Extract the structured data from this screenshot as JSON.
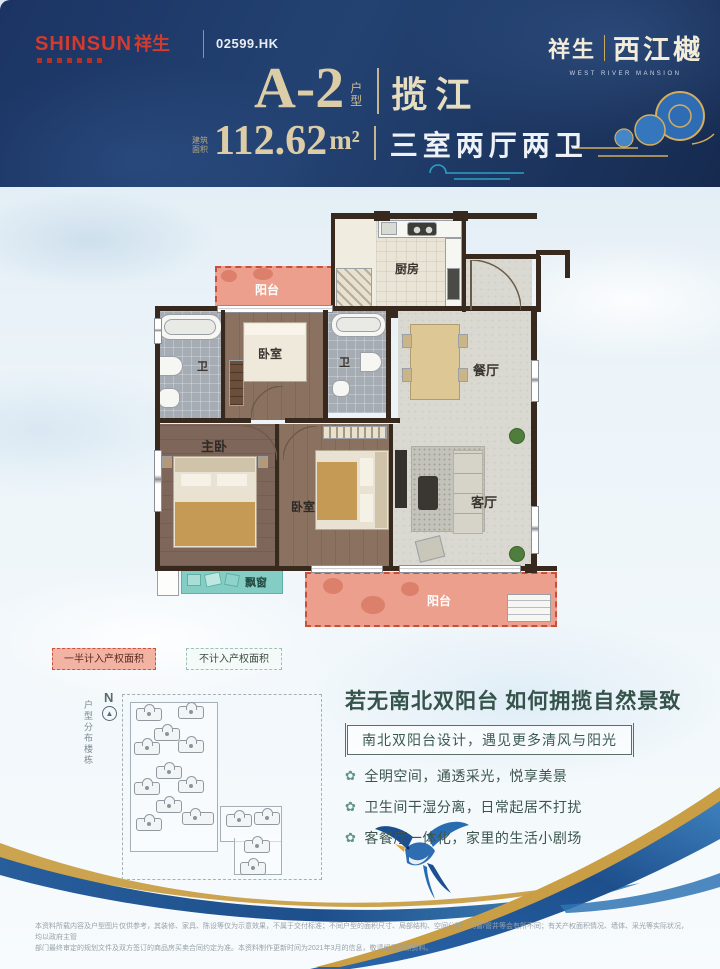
{
  "header": {
    "brand": {
      "en": "SHINSUN",
      "cn": "祥生",
      "stock": "02599.HK"
    },
    "project": {
      "left": "祥生",
      "right": "西江樾",
      "en": "WEST RIVER MANSION"
    },
    "unit_code": "A-2",
    "unit_type_label": "户型",
    "unit_series": "揽江",
    "area_prefix": "建筑面积",
    "area_value": "112.62",
    "area_unit": "m²",
    "layout_desc": "三室两厅两卫"
  },
  "plan": {
    "rooms": {
      "balcony_top": "阳台",
      "kitchen": "厨房",
      "bath_left": "卫",
      "bedroom_top": "卧室",
      "bath_mid": "卫",
      "dining": "餐厅",
      "master": "主卧",
      "bedroom_second": "卧室",
      "living": "客厅",
      "bay_window": "飘窗",
      "balcony_bottom": "阳台"
    }
  },
  "legend": {
    "half_counted": "一半计入产权面积",
    "not_counted": "不计入产权面积"
  },
  "site": {
    "north": "N",
    "side_label": "户型分布楼栋"
  },
  "highlights": {
    "title": "若无南北双阳台  如何拥揽自然景致",
    "subtitle": "南北双阳台设计，遇见更多清风与阳光",
    "bullets": [
      "全明空间，通透采光，悦享美景",
      "卫生间干湿分离，日常起居不打扰",
      "客餐厅一体化，家里的生活小剧场"
    ]
  },
  "icons": {
    "bullet": "✿"
  },
  "disclaimer": {
    "line1": "本资料所载内容及户型图片仅供参考，其装修、家具、陈设等仅为示意效果，不属于交付标准；不同户型的面积尺寸、局部结构、空间分隔、门窗/管井等会有所不同；有关产权面积情况、墙体、采光等实际状况，均以政府主管",
    "line2": "部门最终审定的规划文件及双方签订的商品房买卖合同约定为准。本资料制作更新时间为2021年3月的信息，敬请留意最新资料。"
  },
  "colors": {
    "navy": "#1b3463",
    "gold": "#dccda6",
    "brand_red": "#d23b2e",
    "balcony_pink": "#eb9f8c",
    "balcony_border": "#c94f3c",
    "bay_teal": "#84cdc4",
    "headline_green": "#35534a"
  }
}
